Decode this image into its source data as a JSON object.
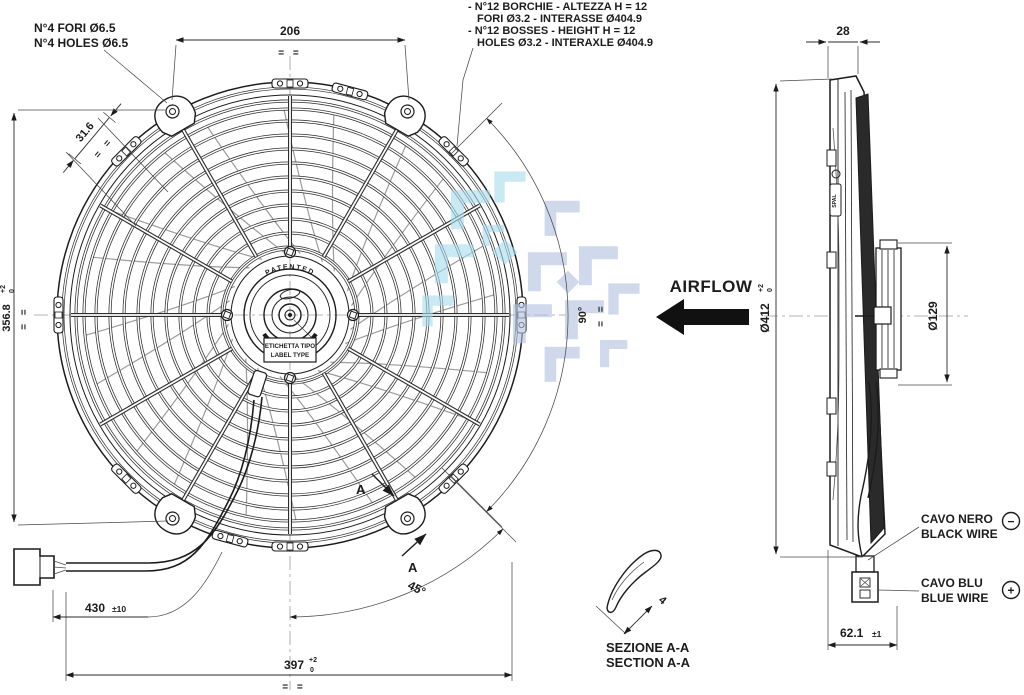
{
  "notes": {
    "holes": [
      "N°4 FORI Ø6.5",
      "N°4 HOLES Ø6.5"
    ],
    "bosses": [
      "- N°12 BORCHIE - ALTEZZA H = 12",
      "FORI Ø3.2 - INTERASSE Ø404.9",
      "- N°12 BOSSES - HEIGHT H = 12",
      "HOLES Ø3.2 - INTERAXLE Ø404.9"
    ]
  },
  "airflow_label": "AIRFLOW",
  "dims": {
    "top_width": "206",
    "bracket_offset": "31.6",
    "mount_height": "356.8",
    "mount_height_tol_up": "+2",
    "mount_height_tol_dn": "0",
    "overall_width": "397",
    "overall_width_tol_up": "+2",
    "overall_width_tol_dn": "0",
    "cable_length": "430",
    "cable_length_tol": "±10",
    "lower_angle": "45°",
    "side_angle": "90°",
    "front_depth": "28",
    "fan_diameter": "Ø412",
    "fan_diameter_tol_up": "+2",
    "fan_diameter_tol_dn": "0",
    "motor_diameter": "Ø129",
    "total_depth": "62.1",
    "total_depth_tol": "±1",
    "blade_thickness": "4",
    "equal_marks": "= ="
  },
  "section": {
    "marker": "A",
    "title": [
      "SEZIONE A-A",
      "SECTION A-A"
    ]
  },
  "wires": {
    "black": [
      "CAVO NERO",
      "BLACK WIRE"
    ],
    "black_polarity": "−",
    "blue": [
      "CAVO BLU",
      "BLUE WIRE"
    ],
    "blue_polarity": "+"
  },
  "hub": {
    "patented": "PATENTED",
    "label": [
      "ETICHETTA TIPO",
      "LABEL TYPE"
    ],
    "brand": "SPAL"
  },
  "colors": {
    "line": "#1c1c1c",
    "watermark_cyan": "#a9dced",
    "watermark_blue": "#b4c2e1"
  }
}
